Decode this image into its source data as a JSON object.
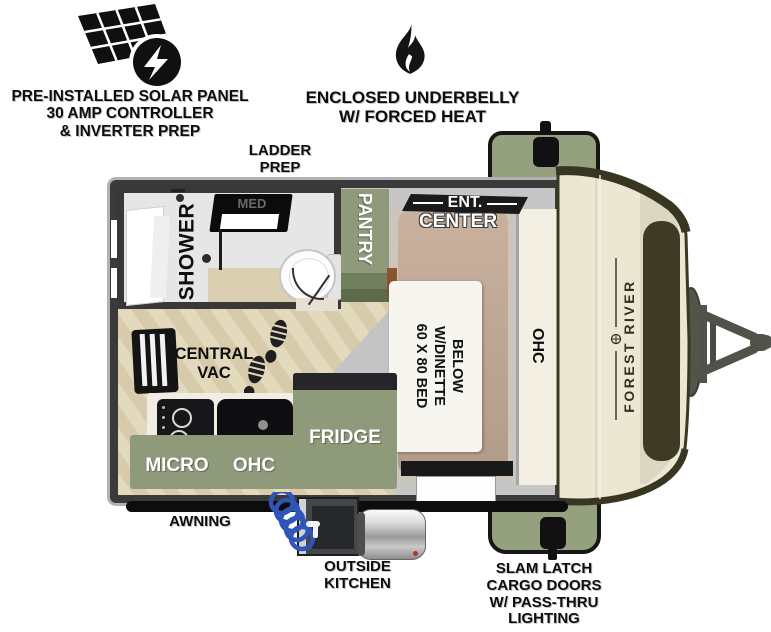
{
  "annotations": {
    "solar": {
      "lines": [
        "PRE-INSTALLED SOLAR PANEL",
        "30 AMP CONTROLLER",
        "& INVERTER PREP"
      ]
    },
    "underbelly": {
      "lines": [
        "ENCLOSED UNDERBELLY",
        "W/ FORCED HEAT"
      ]
    },
    "ladder": {
      "lines": [
        "LADDER",
        "PREP"
      ]
    },
    "awning": {
      "label": "AWNING"
    },
    "outside_kitchen": {
      "lines": [
        "OUTSIDE",
        "KITCHEN"
      ]
    },
    "cargo_doors": {
      "lines": [
        "SLAM LATCH",
        "CARGO DOORS",
        "W/ PASS-THRU",
        "LIGHTING"
      ]
    }
  },
  "floorplan": {
    "labels": {
      "shower": "SHOWER",
      "med": "MED",
      "pantry": "PANTRY",
      "ent": "ENT.",
      "center": "CENTER",
      "bed_lines": [
        "60 X 80 BED",
        "W/DINETTE",
        "BELOW"
      ],
      "ohc_bedside": "OHC",
      "central_vac_lines": [
        "CENTRAL",
        "VAC"
      ],
      "fridge": "FRIDGE",
      "micro": "MICRO",
      "ohc_kitchen": "OHC"
    },
    "brand": "FOREST RIVER"
  },
  "icons": {
    "solar_panel": "solar-panel-icon",
    "flame": "flame-icon",
    "footprints": "footprints-icon",
    "window": "window-icon",
    "hose": "water-hose-icon",
    "water_heater": "water-heater-icon"
  },
  "colors": {
    "sage_green": "#95a07e",
    "wall_dark": "#3a3a3a",
    "cap_cream": "#ece7d3",
    "olive_dark": "#3d3b26",
    "floor_beige": "#dbcfb2",
    "hose_blue": "#3a5fc0",
    "bed_tan": "#bba28e"
  }
}
